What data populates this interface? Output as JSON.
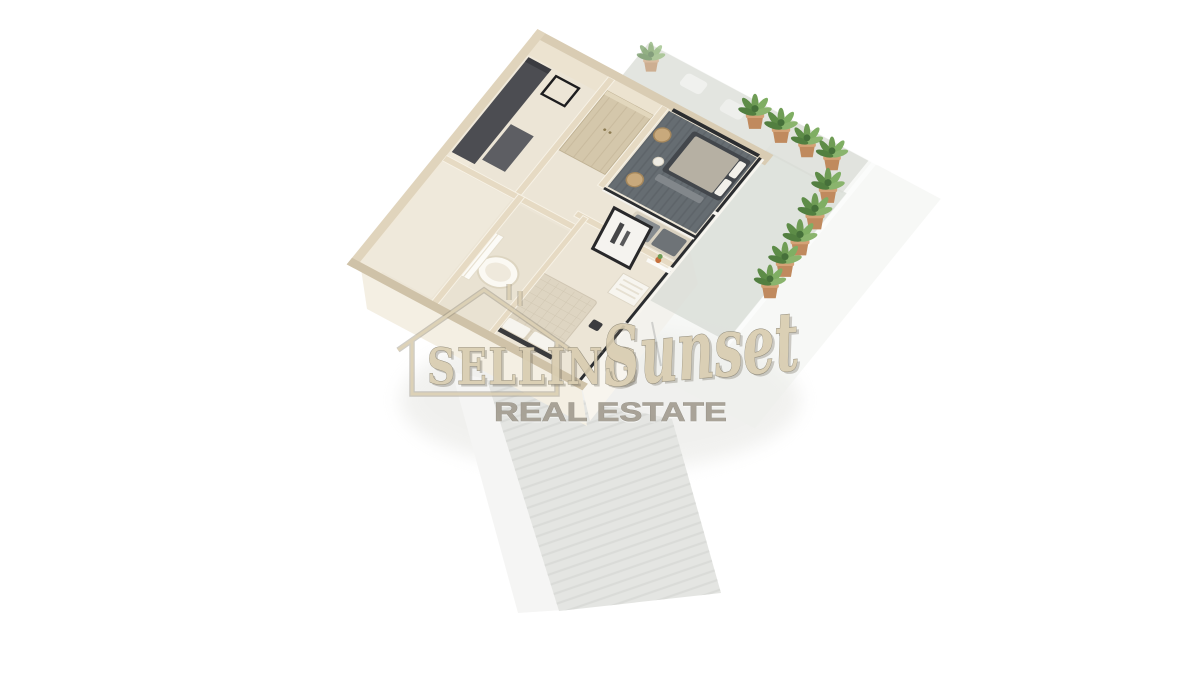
{
  "image": {
    "kind": "3d-floorplan-render",
    "background": "#ffffff"
  },
  "watermark": {
    "selling": "SELLING",
    "sunset": "Sunset",
    "tagline": "REAL ESTATE"
  },
  "scene": {
    "potted_plant_count": 10
  },
  "palette": {
    "background": "#ffffff",
    "wall_top": "#d9ccb3",
    "wall_face_light": "#f0e9da",
    "wall_face_shade": "#e6dac3",
    "floor": "#ece5d6",
    "floor_sw_room": "#efe9db",
    "floor_bathroom": "#e9e2d2",
    "dark_cabinet": "#4c4d52",
    "carpet": "#666d72",
    "bed_dark": "#43474c",
    "bed_quilt": "#ded5c2",
    "sofa_gray": "#878c90",
    "glass_frame": "#2b2d30",
    "terrace": "#d9dcd6",
    "walkway": "#e4e5e2",
    "plant_green": "#6f9c55",
    "plant_pot": "#c08a5e",
    "watermark_beige": "#d9cdb1",
    "watermark_outline": "#8b8574",
    "watermark_gray": "#a49e92"
  }
}
